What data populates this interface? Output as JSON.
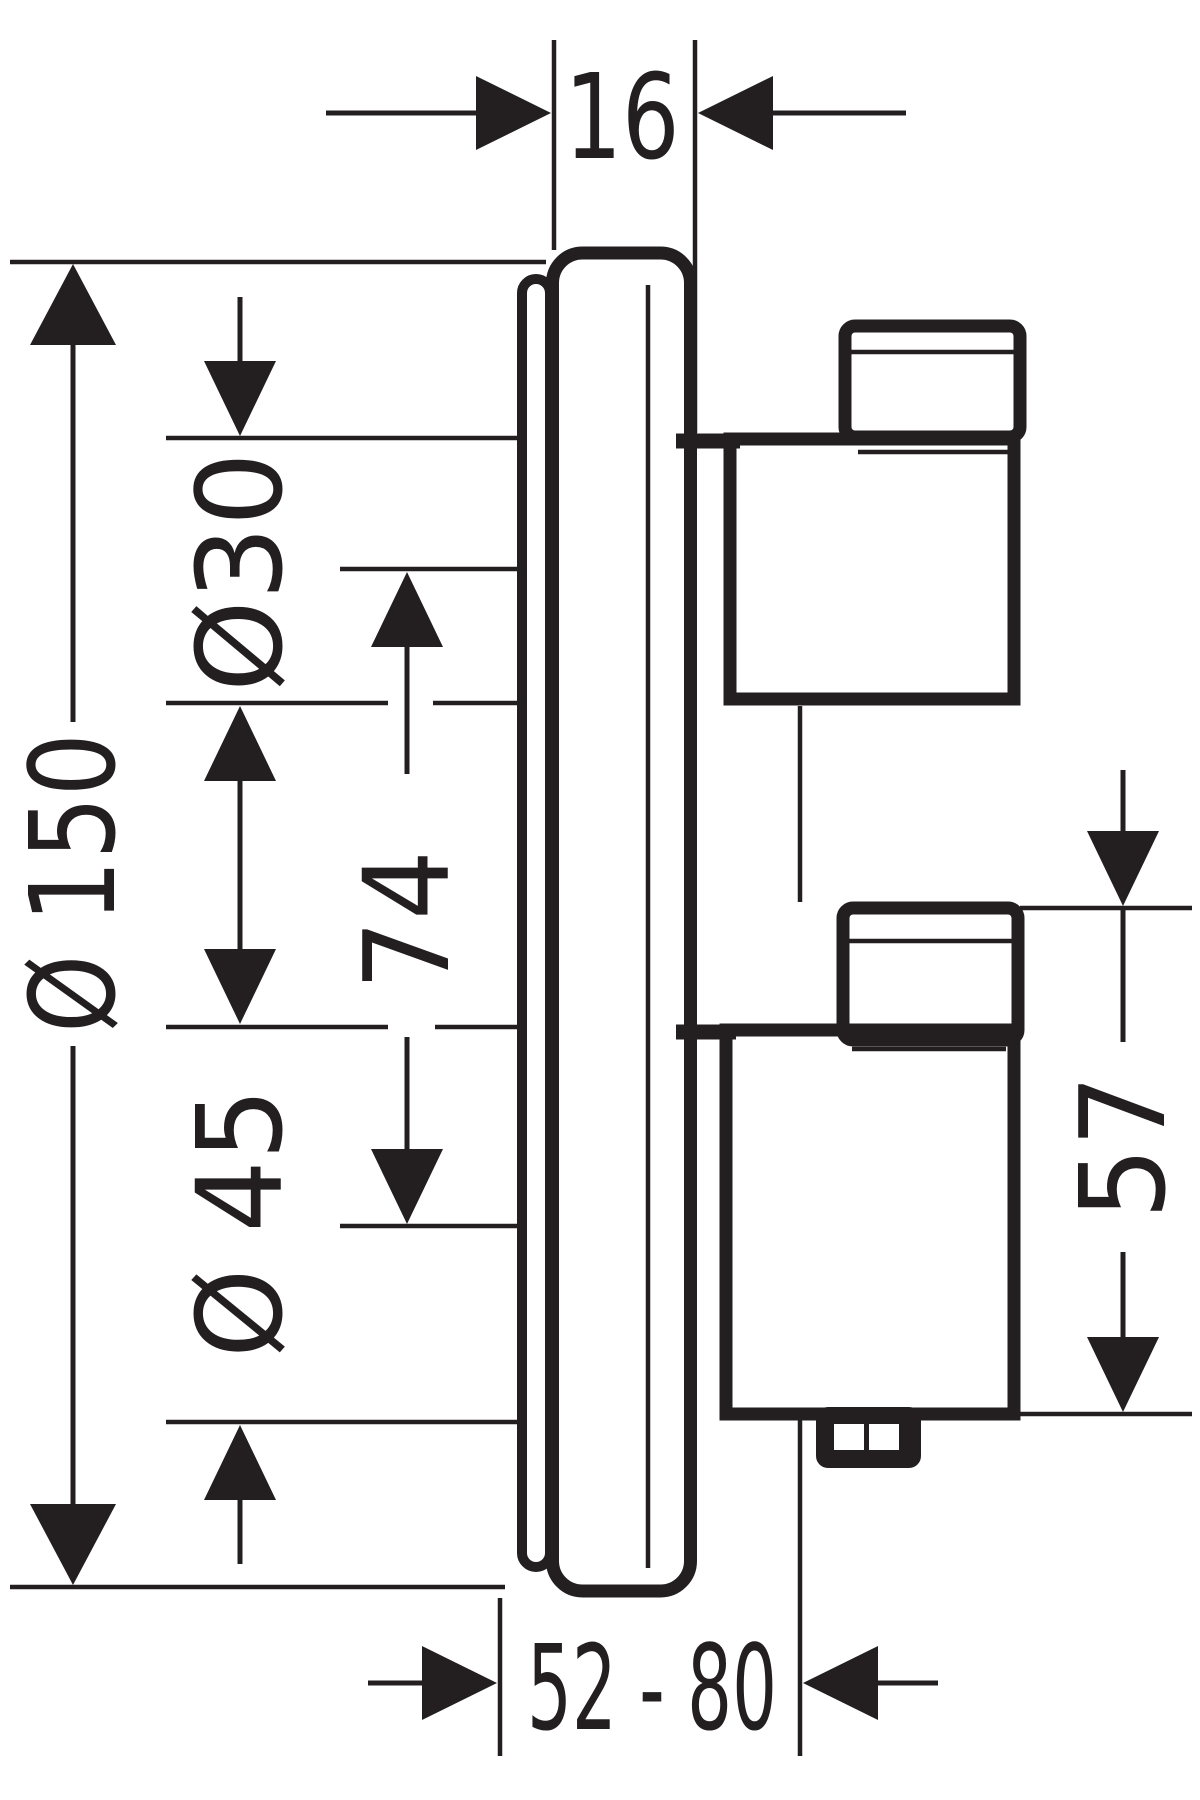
{
  "drawing": {
    "kind": "technical dimension drawing, side view of concealed thermostat trim with two handles",
    "background_color": "#ffffff",
    "line_color": "#231f20",
    "dimensions": {
      "plate_thickness": "16",
      "plate_diameter": "Ø 150",
      "upper_escutcheon_diameter": "Ø30",
      "handle_center_distance": "74",
      "lower_escutcheon_diameter": "Ø 45",
      "lower_handle_height": "57",
      "installation_depth_range": "52 - 80"
    }
  }
}
